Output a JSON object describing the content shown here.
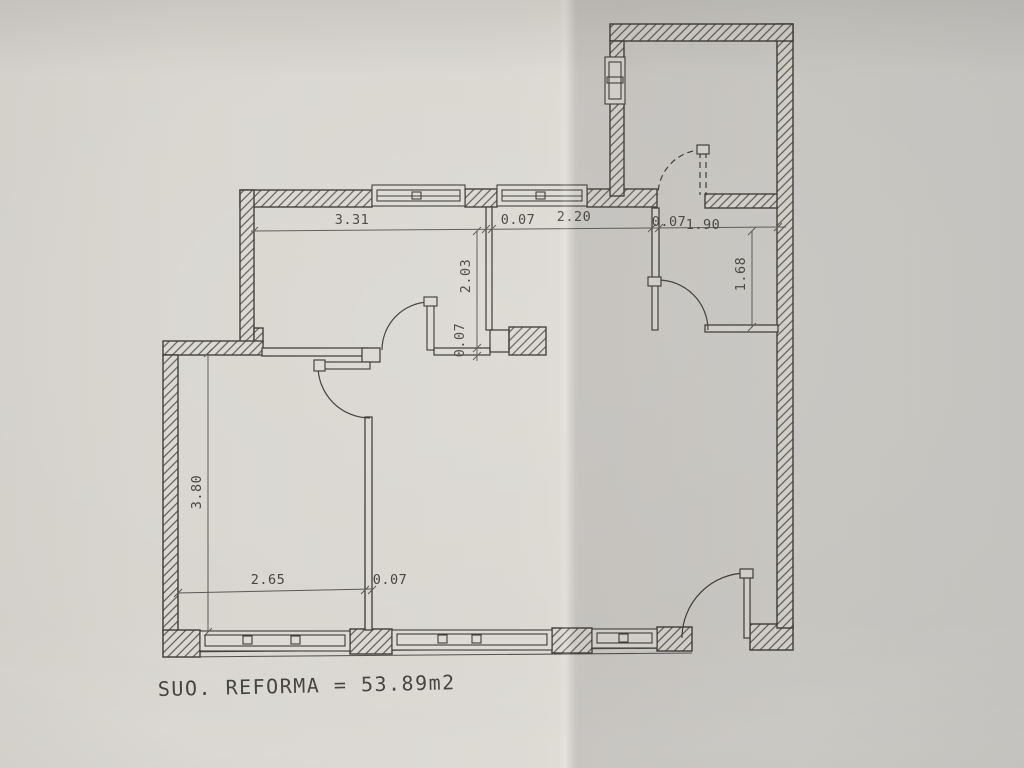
{
  "photo": {
    "caption": "SUO. REFORMA = 53.89m2"
  },
  "dimensions": {
    "room1_width": "3.31",
    "wall_v1": "0.07",
    "hall_width": "2.20",
    "wall_v3": "0.07",
    "room3_width": "1.90",
    "room1_depth": "2.03",
    "wall_h1": "0.07",
    "room3_depth": "1.68",
    "room2_depth": "3.80",
    "room2_width": "2.65",
    "wall_v2": "0.07"
  }
}
